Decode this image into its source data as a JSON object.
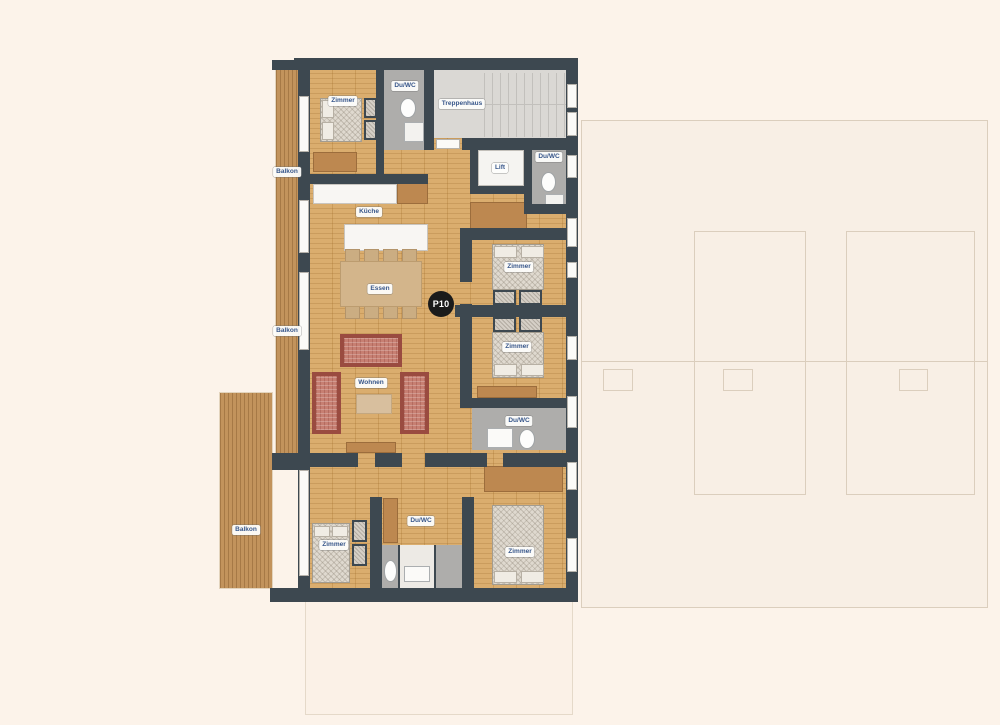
{
  "floorplan": {
    "unit_badge": "P10",
    "labels": [
      {
        "room": "zimmer-top-left",
        "text": "Zimmer"
      },
      {
        "room": "du-wc-top",
        "text": "Du/WC"
      },
      {
        "room": "treppenhaus",
        "text": "Treppenhaus"
      },
      {
        "room": "lift",
        "text": "Lift"
      },
      {
        "room": "du-wc-top-right",
        "text": "Du/WC"
      },
      {
        "room": "kueche",
        "text": "Küche"
      },
      {
        "room": "essen",
        "text": "Essen"
      },
      {
        "room": "wohnen",
        "text": "Wohnen"
      },
      {
        "room": "zimmer-right-upper",
        "text": "Zimmer"
      },
      {
        "room": "zimmer-right-lower",
        "text": "Zimmer"
      },
      {
        "room": "du-wc-middle",
        "text": "Du/WC"
      },
      {
        "room": "zimmer-bottom-left",
        "text": "Zimmer"
      },
      {
        "room": "du-wc-bottom",
        "text": "Du/WC"
      },
      {
        "room": "zimmer-bottom-right",
        "text": "Zimmer"
      },
      {
        "room": "balkon-upper",
        "text": "Balkon"
      },
      {
        "room": "balkon-middle",
        "text": "Balkon"
      },
      {
        "room": "balkon-lower",
        "text": "Balkon"
      }
    ],
    "colors": {
      "wall": "#3D4850",
      "wood_floor": "#D8A966",
      "balcony_deck": "#C2935C",
      "bathroom_floor": "#AEADAB",
      "stairwell_floor": "#DAD8D4",
      "label_text": "#37568A",
      "badge_background": "#1B1B1B",
      "canvas_background": "#FCF3EA"
    }
  }
}
